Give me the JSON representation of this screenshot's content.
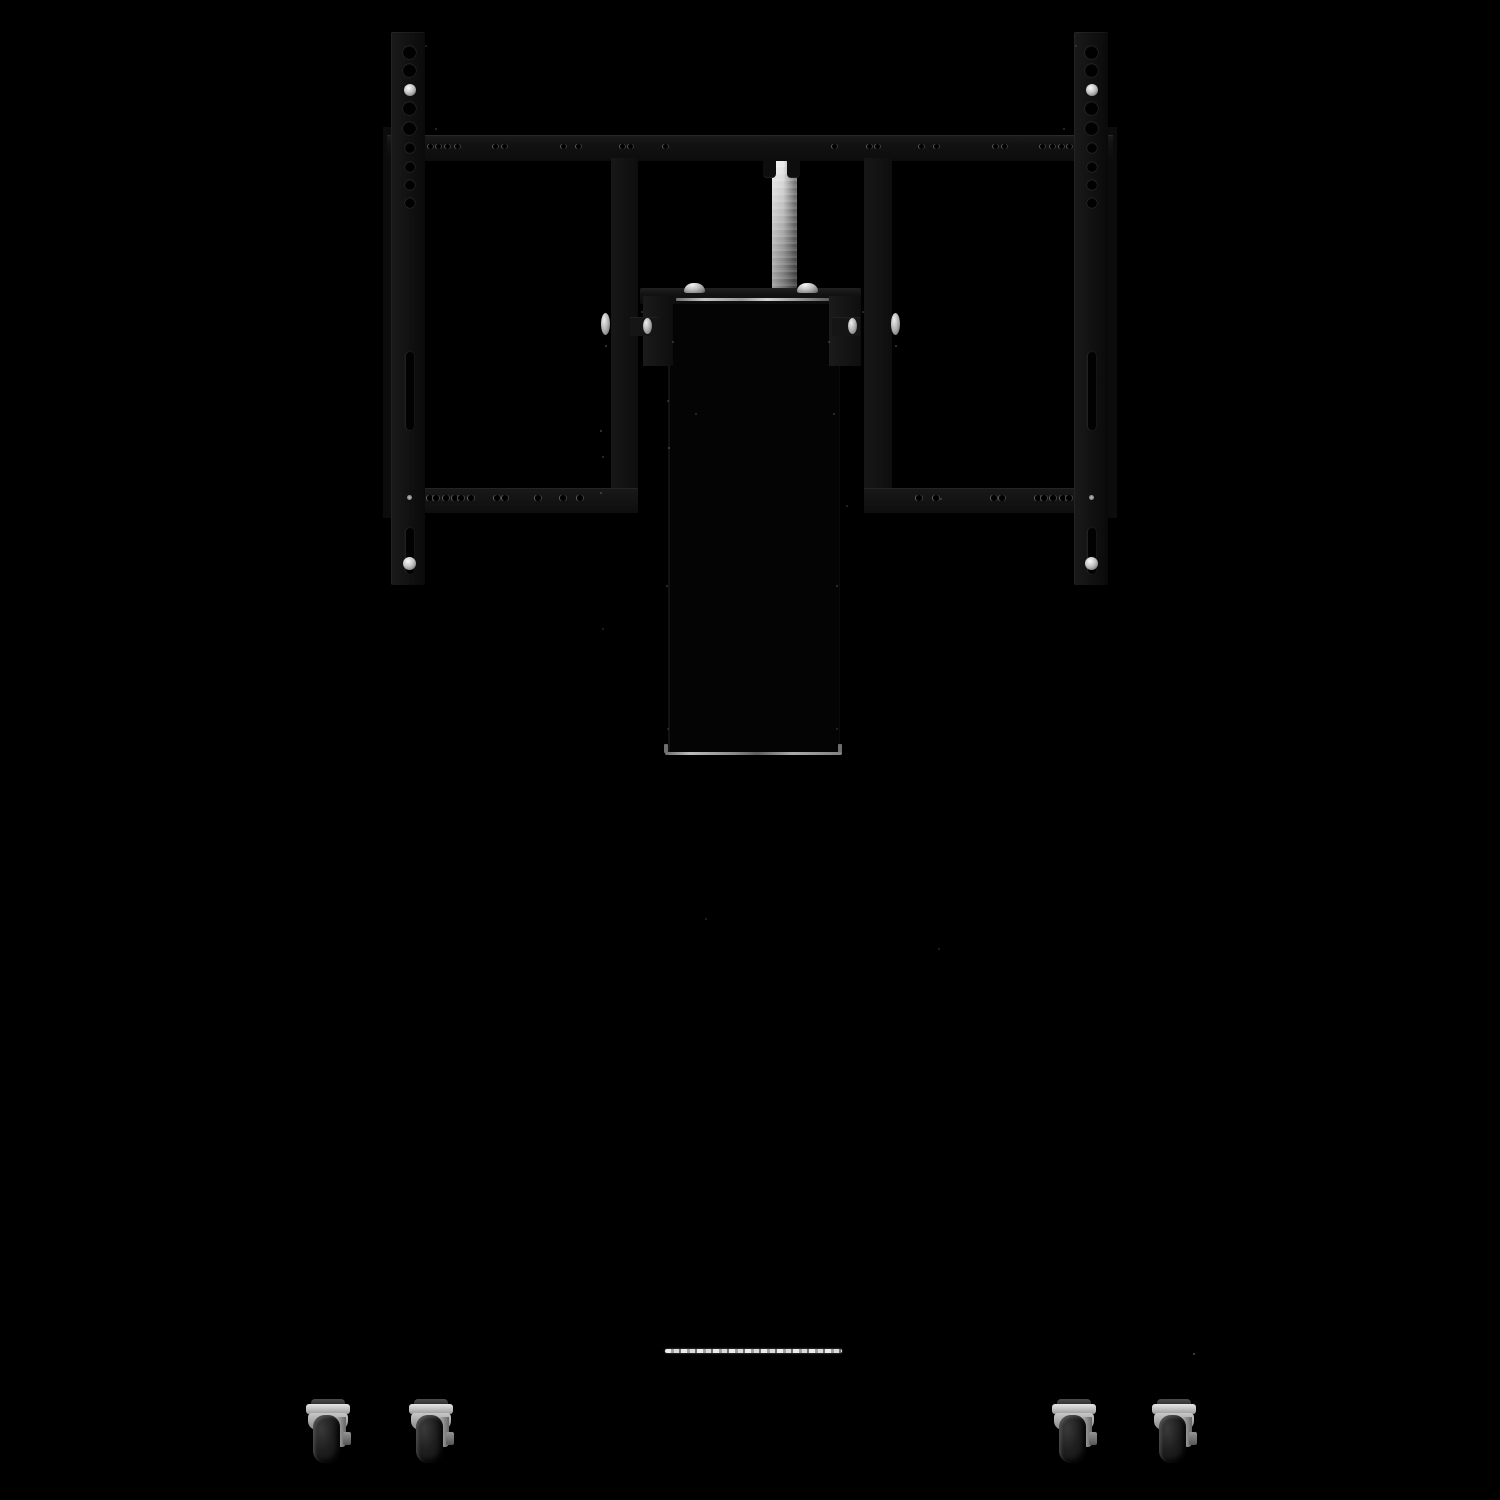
{
  "image": {
    "kind": "product photograph",
    "subject": "black mobile TV display lift stand with VESA mounting rails, chrome gas-spring piston, mount bracket and four swivel casters",
    "visible_text": "",
    "background": "#000000"
  },
  "colors": {
    "background": "#000000",
    "frame_black": "#131313",
    "piston_chrome": "#c9c9c9",
    "bracket_highlight": "#b5b5b5",
    "base_edge_highlight": "#e8e8e8",
    "caster_metal": "#c8c8c8",
    "wheel_rubber": "#1f1f1f",
    "fastener_silver": "#d8d8d8"
  },
  "parts": {
    "vesa_rail_left": "VESA mounting rail (left)",
    "vesa_rail_right": "VESA mounting rail (right)",
    "crossbar": "horizontal mounting crossbar with hole rows",
    "inner_bar_left": "inner vertical bracket bar (left)",
    "inner_bar_right": "inner vertical bracket bar (right)",
    "bottom_bar_left": "lower mounting bar with holes (left)",
    "bottom_bar_right": "lower mounting bar with holes (right)",
    "lift_piston": "chrome gas-spring lift piston",
    "mount_bracket": "display mount bracket with dome bolts",
    "lift_column": "black lift column housing",
    "column_bottom_edge": "column bottom edge highlight",
    "base_top_edge": "base cabinet top edge highlight",
    "caster": "swivel caster with brake"
  }
}
